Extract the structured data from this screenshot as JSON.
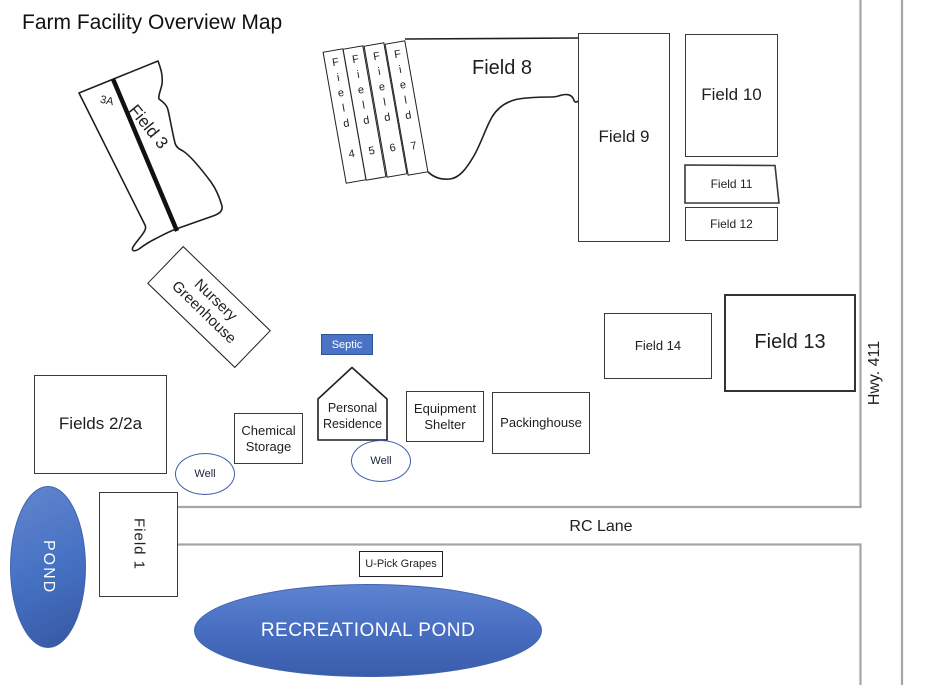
{
  "title": "Farm Facility Overview Map",
  "colors": {
    "water_blue": "#4470C2",
    "water_dark": "#3A5DAB",
    "road_gray": "#A6A6A6",
    "outline_black": "#1F1F1F",
    "septic_blue": "#4A73C6"
  },
  "fields": {
    "f1": {
      "label": "Field 1"
    },
    "f2": {
      "label": "Fields 2/2a"
    },
    "f3": {
      "label": "Field 3",
      "zone": "3A"
    },
    "f4": {
      "label": "Field 4"
    },
    "f5": {
      "label": "Field 5"
    },
    "f6": {
      "label": "Field 6"
    },
    "f7": {
      "label": "Field 7"
    },
    "f8": {
      "label": "Field 8"
    },
    "f9": {
      "label": "Field 9"
    },
    "f10": {
      "label": "Field 10"
    },
    "f11": {
      "label": "Field 11"
    },
    "f12": {
      "label": "Field 12"
    },
    "f13": {
      "label": "Field 13"
    },
    "f14": {
      "label": "Field 14"
    }
  },
  "facilities": {
    "nursery": {
      "label": "Nursery Greenhouse"
    },
    "septic": {
      "label": "Septic"
    },
    "residence": {
      "label": "Personal Residence"
    },
    "chemical": {
      "label": "Chemical Storage"
    },
    "equipment": {
      "label": "Equipment Shelter"
    },
    "packinghouse": {
      "label": "Packinghouse"
    },
    "well_west": {
      "label": "Well"
    },
    "well_east": {
      "label": "Well"
    },
    "upick": {
      "label": "U-Pick Grapes"
    }
  },
  "water": {
    "pond": {
      "label": "POND"
    },
    "recreational_pond": {
      "label": "RECREATIONAL POND"
    }
  },
  "roads": {
    "rc_lane": {
      "label": "RC Lane"
    },
    "highway": {
      "label": "Hwy. 411"
    }
  }
}
